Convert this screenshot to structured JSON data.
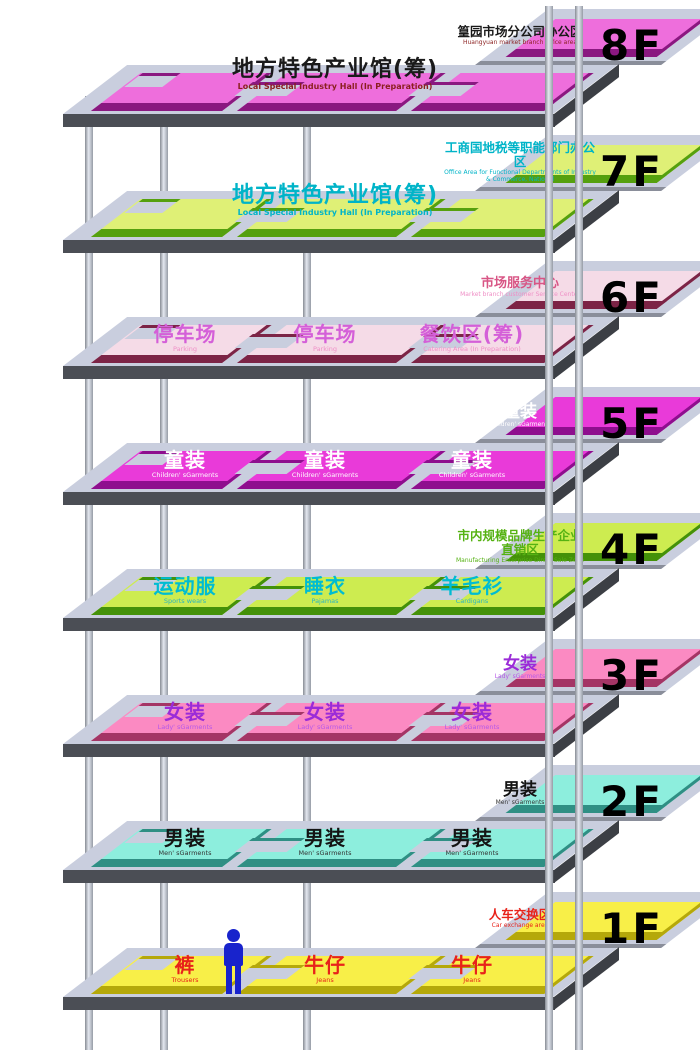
{
  "palette": {
    "slab_top": "#c9cede",
    "slab_front": "#4b4e55",
    "slab_side": "#3c3f45",
    "column": "#c8cdd6",
    "person_marker": "#1823cc"
  },
  "icons": {
    "person": "person-marker"
  },
  "floors": [
    {
      "num": "8F",
      "colors": {
        "pad": "#ee6edc",
        "face": "#8a1880",
        "text": "#1a1a1a",
        "subtext": "#8b1f1f"
      },
      "zones": [
        {
          "cn": "地方特色产业馆(筹)",
          "en": "Local Special Industry Hall (In Preparation)"
        }
      ],
      "back": {
        "cn": "篁园市场分公司办公区",
        "en": "Huangyuan market branch office area"
      }
    },
    {
      "num": "7F",
      "colors": {
        "pad": "#dff076",
        "face": "#55a00e",
        "text": "#00b4c8",
        "subtext": "#00b4c8"
      },
      "zones": [
        {
          "cn": "地方特色产业馆(筹)",
          "en": "Local Special Industry Hall (In Preparation)"
        }
      ],
      "back": {
        "cn": "工商国地税等职能部门办公区",
        "en": "Office Area for Functional Departments of Industry & Commerce, National"
      }
    },
    {
      "num": "6F",
      "colors": {
        "pad": "#f5dbe7",
        "face": "#7c2446",
        "text": "#d45fd8",
        "subtext": "#ef8fc6"
      },
      "zones": [
        {
          "cn": "停车场",
          "en": "Parking"
        },
        {
          "cn": "停车场",
          "en": "Parking"
        },
        {
          "cn": "餐饮区(筹)",
          "en": "Catering Area (In Preparation)"
        }
      ],
      "back": {
        "cn": "市场服务中心",
        "en": "Market branch customer Service Center"
      }
    },
    {
      "num": "5F",
      "colors": {
        "pad": "#e93ad9",
        "face": "#8e0e8e",
        "text": "#ffffff",
        "subtext": "#ffffff"
      },
      "zones": [
        {
          "cn": "童装",
          "en": "Children' sGarments"
        },
        {
          "cn": "童装",
          "en": "Children' sGarments"
        },
        {
          "cn": "童装",
          "en": "Children' sGarments"
        }
      ],
      "back": {
        "cn": "童装",
        "en": "Children' sGarments"
      }
    },
    {
      "num": "4F",
      "colors": {
        "pad": "#cdec50",
        "face": "#449109",
        "text": "#00bcd2",
        "subtext": "#55b212"
      },
      "zones": [
        {
          "cn": "运动服",
          "en": "Sports wears"
        },
        {
          "cn": "睡衣",
          "en": "Pajamas"
        },
        {
          "cn": "羊毛衫",
          "en": "Cardigans"
        }
      ],
      "back": {
        "cn": "市内规模品牌生产企业直销区",
        "en": "Manufacturing Enterprise Direct Sale Zone"
      }
    },
    {
      "num": "3F",
      "colors": {
        "pad": "#fb8ac2",
        "face": "#a43565",
        "text": "#9b2bd8",
        "subtext": "#b558e8"
      },
      "zones": [
        {
          "cn": "女装",
          "en": "Lady' sGarments"
        },
        {
          "cn": "女装",
          "en": "Lady' sGarments"
        },
        {
          "cn": "女装",
          "en": "Lady' sGarments"
        }
      ],
      "back": {
        "cn": "女装",
        "en": "Lady' sGarments"
      }
    },
    {
      "num": "2F",
      "colors": {
        "pad": "#8deedd",
        "face": "#2f8f84",
        "text": "#141414",
        "subtext": "#333333"
      },
      "zones": [
        {
          "cn": "男装",
          "en": "Men' sGarments"
        },
        {
          "cn": "男装",
          "en": "Men' sGarments"
        },
        {
          "cn": "男装",
          "en": "Men' sGarments"
        }
      ],
      "back": {
        "cn": "男装",
        "en": "Men' sGarments"
      }
    },
    {
      "num": "1F",
      "colors": {
        "pad": "#f8ef48",
        "face": "#b5a80a",
        "text": "#e8221a",
        "subtext": "#e8221a"
      },
      "zones": [
        {
          "cn": "裤",
          "en": "Trousers"
        },
        {
          "cn": "牛仔",
          "en": "Jeans"
        },
        {
          "cn": "牛仔",
          "en": "Jeans"
        }
      ],
      "back": {
        "cn": "人车交换区",
        "en": "Car exchange area"
      }
    }
  ]
}
